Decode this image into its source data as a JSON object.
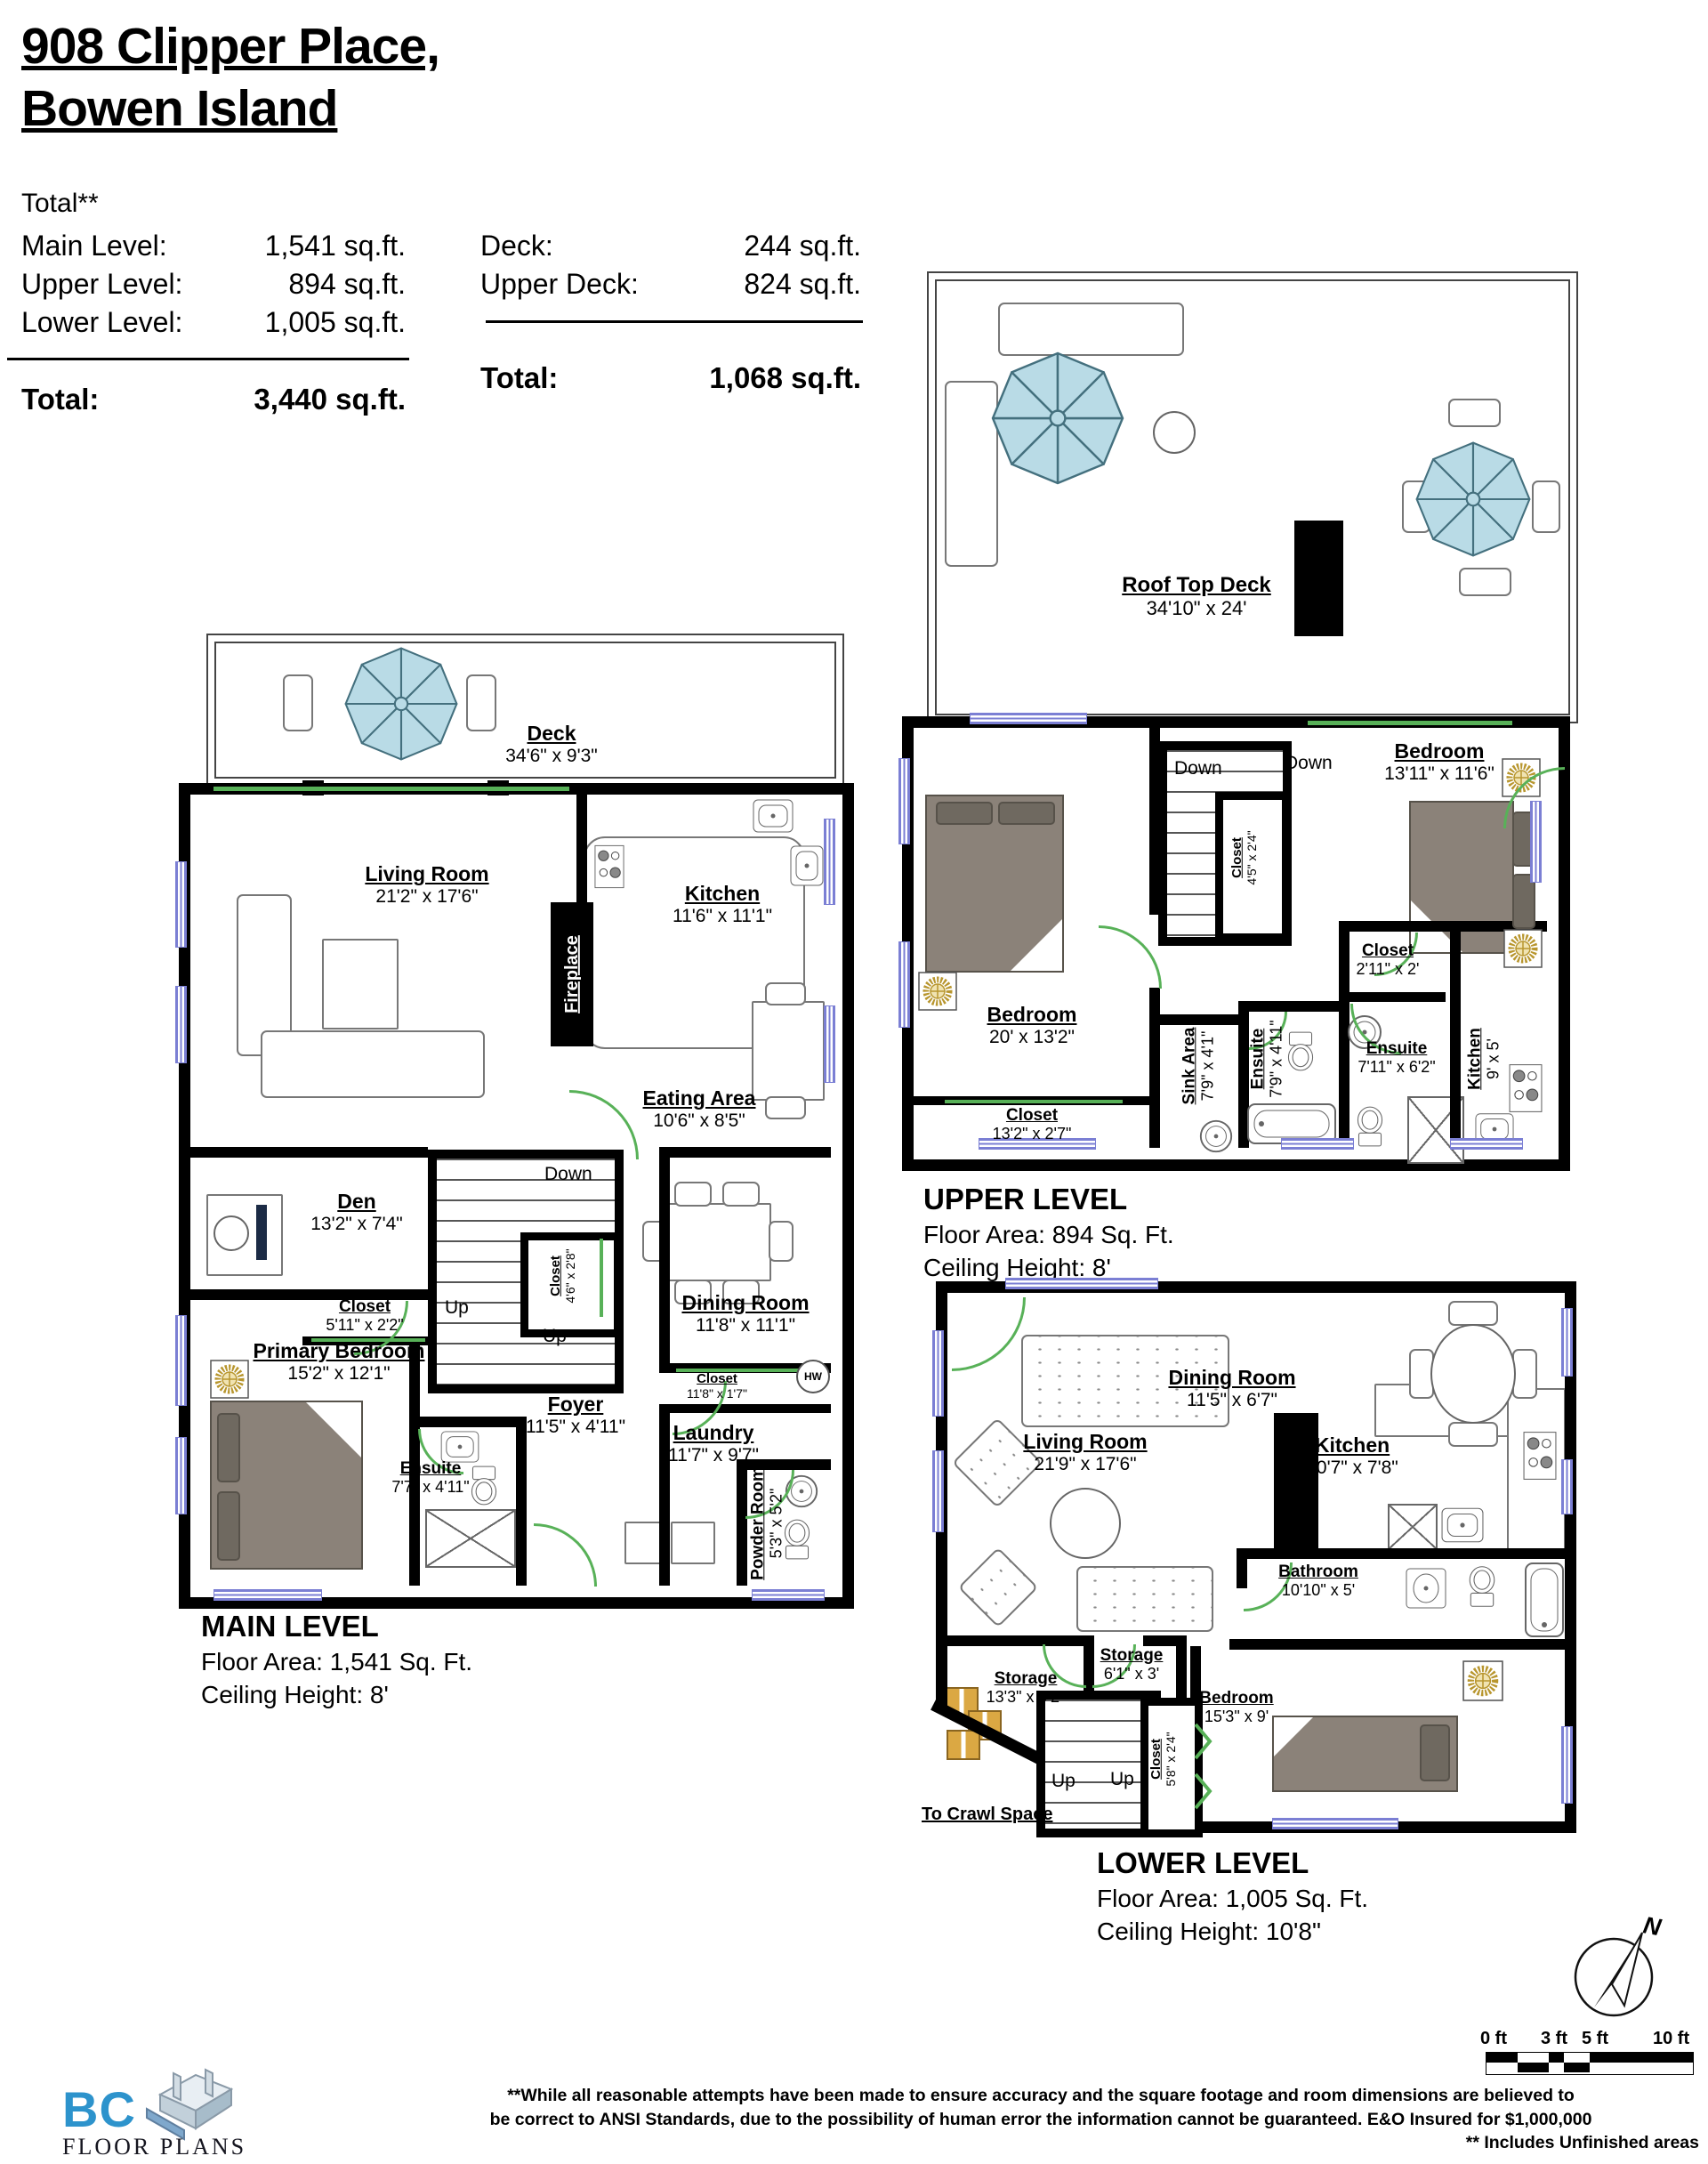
{
  "title": {
    "line1": "908 Clipper Place,",
    "line2": "Bowen Island"
  },
  "summary": {
    "total_heading": "Total**",
    "left_rows": [
      {
        "label": "Main Level:",
        "value": "1,541 sq.ft."
      },
      {
        "label": "Upper Level:",
        "value": "894 sq.ft."
      },
      {
        "label": "Lower Level:",
        "value": "1,005 sq.ft."
      }
    ],
    "left_total": {
      "label": "Total:",
      "value": "3,440 sq.ft."
    },
    "right_rows": [
      {
        "label": "Deck:",
        "value": "244 sq.ft."
      },
      {
        "label": "Upper Deck:",
        "value": "824 sq.ft."
      }
    ],
    "right_total": {
      "label": "Total:",
      "value": "1,068 sq.ft."
    }
  },
  "levels": {
    "roof": {
      "name": "Roof Top Deck",
      "dims": "34'10\" x 24'"
    },
    "main": {
      "caption": {
        "name": "MAIN LEVEL",
        "area": "Floor Area: 1,541 Sq. Ft.",
        "ceiling": "Ceiling Height: 8'"
      },
      "rooms": {
        "deck": {
          "name": "Deck",
          "dims": "34'6\" x 9'3\""
        },
        "living": {
          "name": "Living Room",
          "dims": "21'2\" x 17'6\""
        },
        "kitchen": {
          "name": "Kitchen",
          "dims": "11'6\" x 11'1\""
        },
        "fireplace": {
          "name": "Fireplace"
        },
        "eating": {
          "name": "Eating Area",
          "dims": "10'6\" x 8'5\""
        },
        "den": {
          "name": "Den",
          "dims": "13'2\" x 7'4\""
        },
        "closet_stairs": {
          "name": "Closet",
          "dims": "4'6\" x 2'8\""
        },
        "closet_den": {
          "name": "Closet",
          "dims": "5'11\" x 2'2\""
        },
        "dining": {
          "name": "Dining Room",
          "dims": "11'8\" x 11'1\""
        },
        "primary": {
          "name": "Primary Bedroom",
          "dims": "15'2\" x 12'1\""
        },
        "closet_hall": {
          "name": "Closet",
          "dims": "11'8\" x 1'7\""
        },
        "foyer": {
          "name": "Foyer",
          "dims": "11'5\" x 4'11\""
        },
        "laundry": {
          "name": "Laundry",
          "dims": "11'7\" x 9'7\""
        },
        "ensuite": {
          "name": "Ensuite",
          "dims": "7'7\" x 4'11\""
        },
        "powder": {
          "name": "Powder Room",
          "dims": "5'3\" x 5'2\""
        }
      },
      "ann": {
        "down": "Down",
        "up1": "Up",
        "up2": "Up",
        "hw": "HW"
      }
    },
    "upper": {
      "caption": {
        "name": "UPPER LEVEL",
        "area": "Floor Area: 894 Sq. Ft.",
        "ceiling": "Ceiling Height: 8'"
      },
      "rooms": {
        "bedroom_right": {
          "name": "Bedroom",
          "dims": "13'11\" x 11'6\""
        },
        "closet_stairs": {
          "name": "Closet",
          "dims": "4'5\" x 2'4\""
        },
        "bedroom_left": {
          "name": "Bedroom",
          "dims": "20' x 13'2\""
        },
        "closet_bed": {
          "name": "Closet",
          "dims": "13'2\" x 2'7\""
        },
        "sink_area": {
          "name": "Sink Area",
          "dims": "7'9\" x 4'1\""
        },
        "ensuite_left": {
          "name": "Ensuite",
          "dims": "7'9\" x 4'11\""
        },
        "closet_small": {
          "name": "Closet",
          "dims": "2'11\" x 2'"
        },
        "ensuite_right": {
          "name": "Ensuite",
          "dims": "7'11\" x 6'2\""
        },
        "kitchen": {
          "name": "Kitchen",
          "dims": "9' x 5'"
        }
      },
      "ann": {
        "down1": "Down",
        "down2": "Down"
      }
    },
    "lower": {
      "caption": {
        "name": "LOWER LEVEL",
        "area": "Floor Area: 1,005 Sq. Ft.",
        "ceiling": "Ceiling Height: 10'8\""
      },
      "rooms": {
        "living": {
          "name": "Living Room",
          "dims": "21'9\" x 17'6\""
        },
        "dining": {
          "name": "Dining Room",
          "dims": "11'5\" x 6'7\""
        },
        "kitchen": {
          "name": "Kitchen",
          "dims": "10'7\" x 7'8\""
        },
        "bathroom": {
          "name": "Bathroom",
          "dims": "10'10\" x 5'"
        },
        "storage_small": {
          "name": "Storage",
          "dims": "6'1\" x 3'"
        },
        "storage_big": {
          "name": "Storage",
          "dims": "13'3\" x 9'2\""
        },
        "bedroom": {
          "name": "Bedroom",
          "dims": "15'3\" x 9'"
        },
        "closet": {
          "name": "Closet",
          "dims": "5'8\" x 2'4\""
        }
      },
      "ann": {
        "up1": "Up",
        "up2": "Up",
        "crawl": "To Crawl Space"
      }
    }
  },
  "compass": {
    "n": "N"
  },
  "scalebar": {
    "labels": [
      "0 ft",
      "3 ft",
      "5 ft",
      "10 ft"
    ]
  },
  "logo": {
    "bc": "BC",
    "floor_plans": "FLOOR PLANS"
  },
  "disclaimer": {
    "line1": "**While all reasonable attempts have been made to ensure accuracy and the square footage and room dimensions are believed to",
    "line2": "be correct to ANSI Standards, due to the possibility of human error the information cannot be guaranteed. E&O Insured for $1,000,000",
    "line3": "** Includes Unfinished areas"
  }
}
